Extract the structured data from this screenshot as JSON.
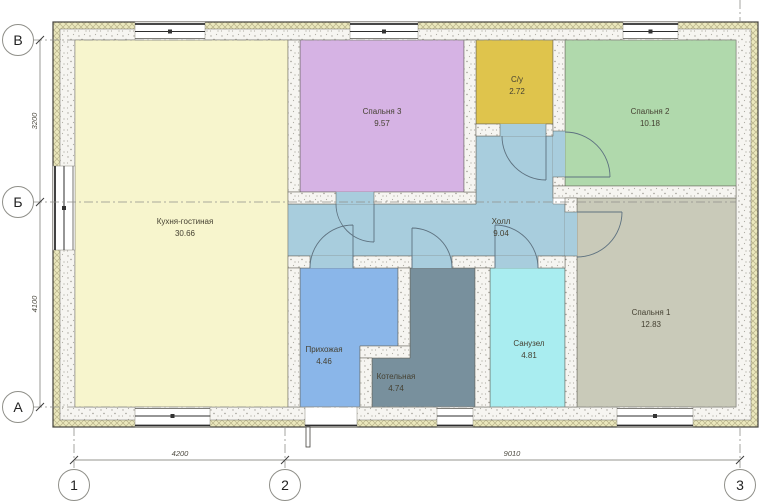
{
  "drawing": {
    "type": "floor-plan",
    "rooms": [
      {
        "id": "kitchen-living",
        "name": "Кухня-гостиная",
        "area": "30.66",
        "color": "#f7f5cd"
      },
      {
        "id": "bedroom-3",
        "name": "Спальня 3",
        "area": "9.57",
        "color": "#d6b3e4"
      },
      {
        "id": "wc-su",
        "name": "С/у",
        "area": "2.72",
        "color": "#dfc44c"
      },
      {
        "id": "bedroom-2",
        "name": "Спальня 2",
        "area": "10.18",
        "color": "#b0d9ac"
      },
      {
        "id": "hall",
        "name": "Холл",
        "area": "9.04",
        "color": "#a8cddd"
      },
      {
        "id": "entry",
        "name": "Прихожая",
        "area": "4.46",
        "color": "#8ab6e9"
      },
      {
        "id": "boiler-room",
        "name": "Котельная",
        "area": "4.74",
        "color": "#78909d"
      },
      {
        "id": "bathroom",
        "name": "Санузел",
        "area": "4.81",
        "color": "#a9edf0"
      },
      {
        "id": "bedroom-1",
        "name": "Спальня 1",
        "area": "12.83",
        "color": "#c9cab9"
      }
    ],
    "axes": {
      "left": [
        {
          "label": "В"
        },
        {
          "label": "Б"
        },
        {
          "label": "А"
        }
      ],
      "bottom": [
        {
          "label": "1"
        },
        {
          "label": "2"
        },
        {
          "label": "3"
        }
      ]
    },
    "dimensions": {
      "left": [
        "3200",
        "4100"
      ],
      "bottom": [
        "4200",
        "9010"
      ]
    },
    "colors": {
      "wall_fill": "#f6f5f1",
      "insulation_hatch": "#ebe8bd",
      "line": "#44423c",
      "door_line": "#5e7280"
    }
  }
}
